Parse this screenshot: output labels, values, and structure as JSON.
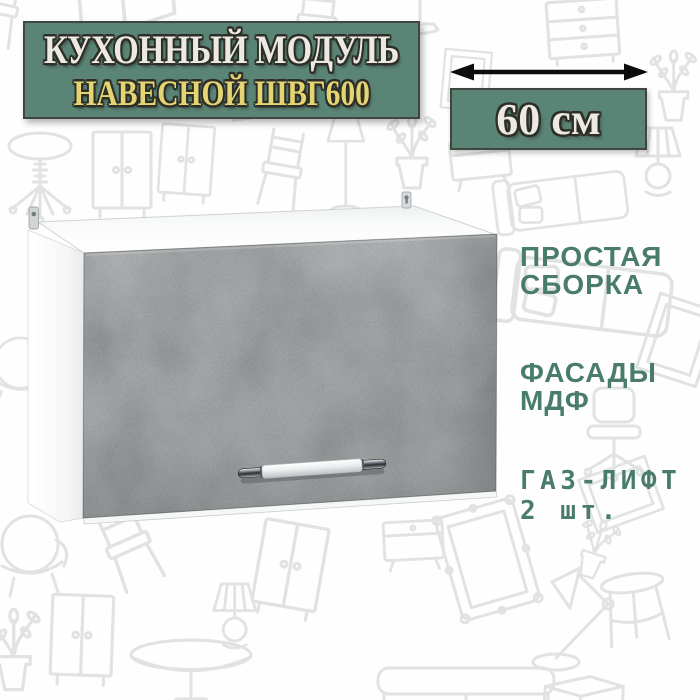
{
  "title_banner": {
    "line1": "КУХОННЫЙ МОДУЛЬ",
    "line2": "НАВЕСНОЙ ШВГ600",
    "bg_color": "#5a8475",
    "border_color": "#3e463e",
    "line1_color": "#ebe9e1",
    "line2_color": "#e5d572",
    "outline_color": "#2e2e29"
  },
  "dimension_callout": {
    "value": "60 см",
    "arrow_icon": "double-headed-horizontal-arrow",
    "arrow_color": "#0c0c0c",
    "box_bg_color": "#5a8475",
    "box_border_color": "#3e463e",
    "value_color": "#ebe9e1"
  },
  "features": {
    "text_color": "#4a7c6a",
    "items": [
      {
        "lines": [
          "ПРОСТАЯ",
          "СБОРКА"
        ]
      },
      {
        "lines": [
          "ФАСАДЫ",
          "МДФ"
        ]
      },
      {
        "lines": [
          "ГАЗ-ЛИФТ",
          "2 шт."
        ]
      }
    ]
  },
  "product_render": {
    "carcass_color": "#ffffff",
    "facade_color": "#74787a",
    "handle_style": "chrome-bar-handle",
    "mount_brackets": 2
  },
  "background": {
    "color": "#ffffff",
    "doodle_color": "#e1e2e2",
    "doodle_theme": "furniture line-art pattern"
  }
}
